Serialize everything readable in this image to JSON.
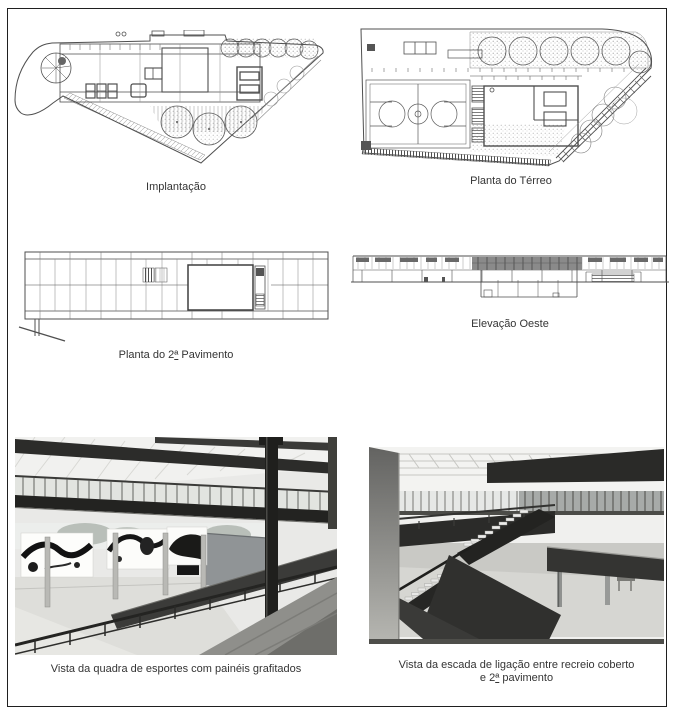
{
  "page": {
    "background": "#ffffff",
    "frame_color": "#1f1f1f",
    "text_color": "#343434"
  },
  "figures": {
    "implantacao": {
      "type": "drawing",
      "caption": "Implantação"
    },
    "terreo": {
      "type": "drawing",
      "caption": "Planta do Térreo"
    },
    "pavimento2": {
      "type": "drawing",
      "caption_prefix": "Planta do 2",
      "caption_ordinal": "ª",
      "caption_suffix": " Pavimento"
    },
    "elevacao": {
      "type": "drawing",
      "caption": "Elevação Oeste"
    },
    "foto_quadra": {
      "type": "photo",
      "caption": "Vista da quadra de esportes com painéis grafitados"
    },
    "foto_escada": {
      "type": "photo",
      "caption_line1": "Vista da escada de ligação entre recreio coberto",
      "caption_line2_prefix": "e  2",
      "caption_line2_ordinal": "ª",
      "caption_line2_suffix": "  pavimento"
    }
  }
}
